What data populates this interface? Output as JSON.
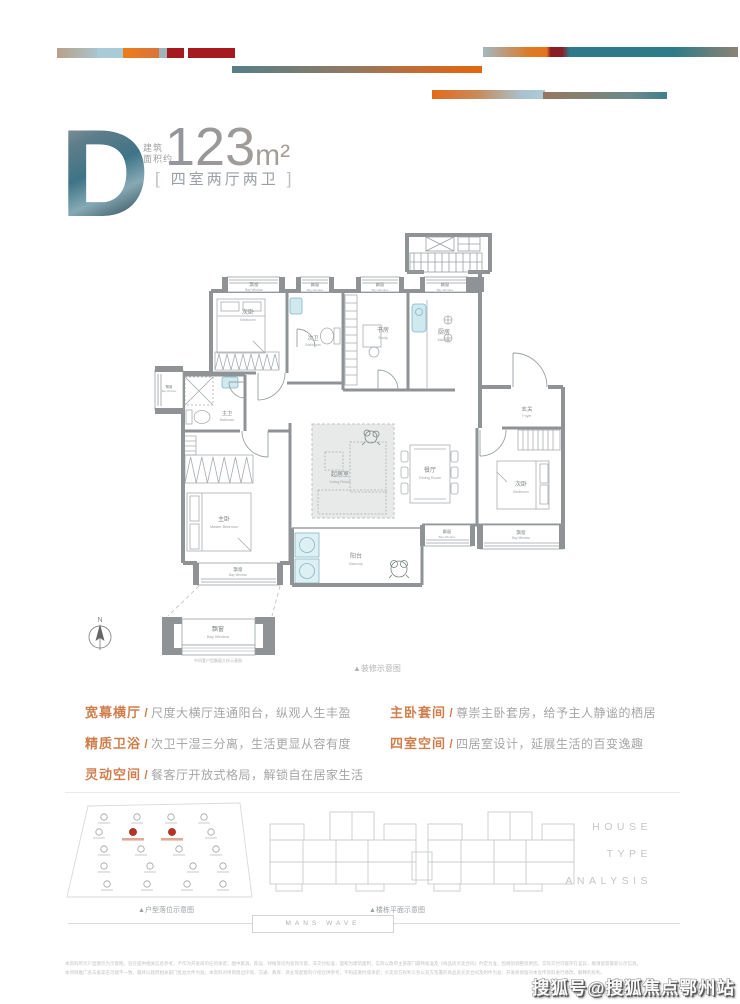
{
  "header": {
    "letter": "D",
    "area_label_line1": "建筑",
    "area_label_line2": "面积约",
    "area_value": "123",
    "area_unit": "m²",
    "bracket_open": "[",
    "bracket_close": "]",
    "layout_label": "四室两厅两卫"
  },
  "plan": {
    "bay_cn": "飘窗",
    "bay_en": "Bay Window",
    "rooms": {
      "bedroom_cn": "次卧",
      "bedroom_en": "Bedroom",
      "master_cn": "主卧",
      "master_en": "Master Bedroom",
      "bath2_cn": "次卫",
      "bath1_cn": "主卫",
      "bath_en": "Bathroom",
      "study_cn": "书房",
      "study_en": "Study",
      "kitchen_cn": "厨房",
      "kitchen_en": "Kitchen",
      "living_cn": "起居室",
      "living_en": "Living Room",
      "dining_cn": "餐厅",
      "dining_en": "Dining Room",
      "balcony_cn": "阳台",
      "balcony_en": "Balcony",
      "foyer_cn": "玄关",
      "foyer_en": "Foyer"
    },
    "compass_label": "N",
    "bay_detail_caption": "中间套户型飘窗大样示意图",
    "plan_note": "▲装修示意图"
  },
  "features": {
    "separator": "/",
    "left": [
      {
        "label": "宽幕横厅",
        "desc": "尺度大横厅连通阳台，纵观人生丰盈"
      },
      {
        "label": "精质卫浴",
        "desc": "次卫干湿三分离，生活更显从容有度"
      },
      {
        "label": "灵动空间",
        "desc": "餐客厅开放式格局，解锁自在居家生活"
      }
    ],
    "right": [
      {
        "label": "主卧套间",
        "desc": "尊崇主卧套房，给予主人静谧的栖居"
      },
      {
        "label": "四室空间",
        "desc": "四居室设计，延展生活的百变逸趣"
      }
    ]
  },
  "footer": {
    "site_caption": "▲户型落位示意图",
    "floor_caption": "▲楼栋平面示意图",
    "analysis": [
      "HOUSE",
      "TYPE",
      "ANALYSIS"
    ],
    "brand": "MANS WAVE",
    "disclaimer_line1": "本资料所示户型图仅为示意图，旨在提供相关信息参考，不作为开发商的任何承诺；图中家具、陈设、绿植等均为装饰示意，非交付标准；面积为建筑面积，实际以政府主管部门最终核准及《商品房买卖合同》约定为准；因规划调整等原因，实际交付可能存在差异，敬请留意最新公示信息。",
    "disclaimer_line2": "本项目推广名与备案名可能不一致，最终以政府相关部门批准文件为准；本资料对项目周边环境、交通、教育、商业等配套的介绍仅供参考，不构成要约或承诺；买卖双方权利义务以双方签署的商品房买卖合同及附件为准；开发商保留对本宣传资料进行修改、解释的权利。",
    "watermark": "搜狐号@搜狐焦点鄂州站"
  },
  "colors": {
    "accent_orange": "#cf7f4e",
    "teal": "#2e7b8a",
    "crimson": "#a6191e",
    "tan": "#b7a189",
    "light_blue": "#a9cad7",
    "wall_gray": "#8f9396"
  }
}
